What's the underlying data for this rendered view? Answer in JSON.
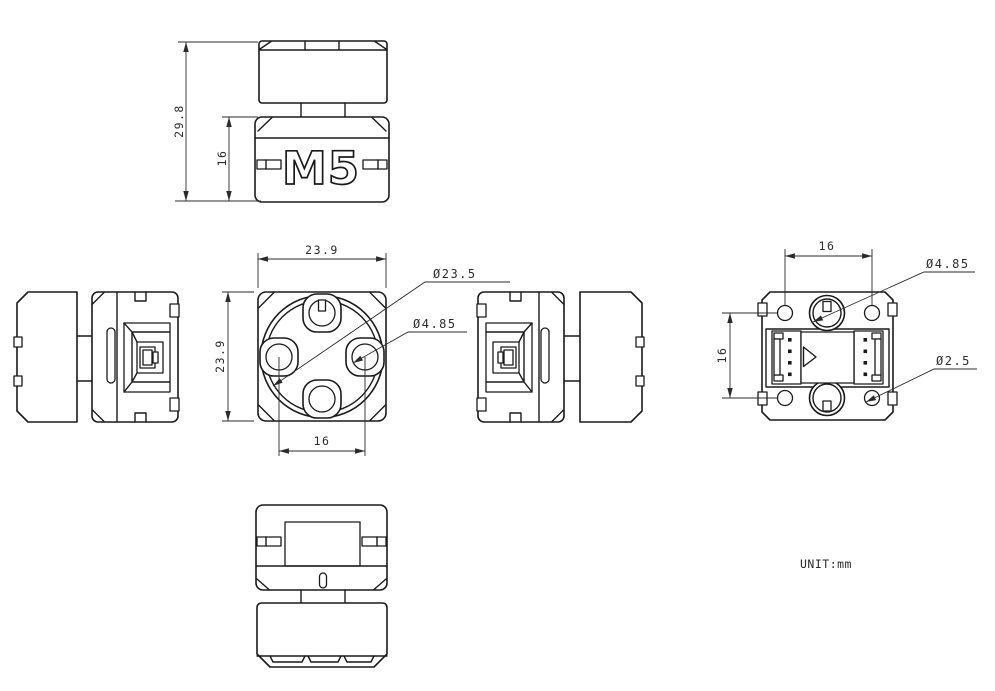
{
  "title": "M5 module engineering drawing",
  "unit_label": "UNIT:mm",
  "logo_text": "M5",
  "colors": {
    "line": "#1a1a1a",
    "background": "#ffffff"
  },
  "dimensions": {
    "front_overall_height": "29.8",
    "front_body_height": "16",
    "top_width": "23.9",
    "top_height": "23.9",
    "top_hole_spacing": "16",
    "top_outer_diameter": "Ø23.5",
    "top_hole_diameter": "Ø4.85",
    "bottom_hole_spacing_horizontal": "16",
    "bottom_hole_spacing_vertical": "16",
    "bottom_hole_diameter": "Ø4.85",
    "bottom_small_hole_diameter": "Ø2.5"
  }
}
